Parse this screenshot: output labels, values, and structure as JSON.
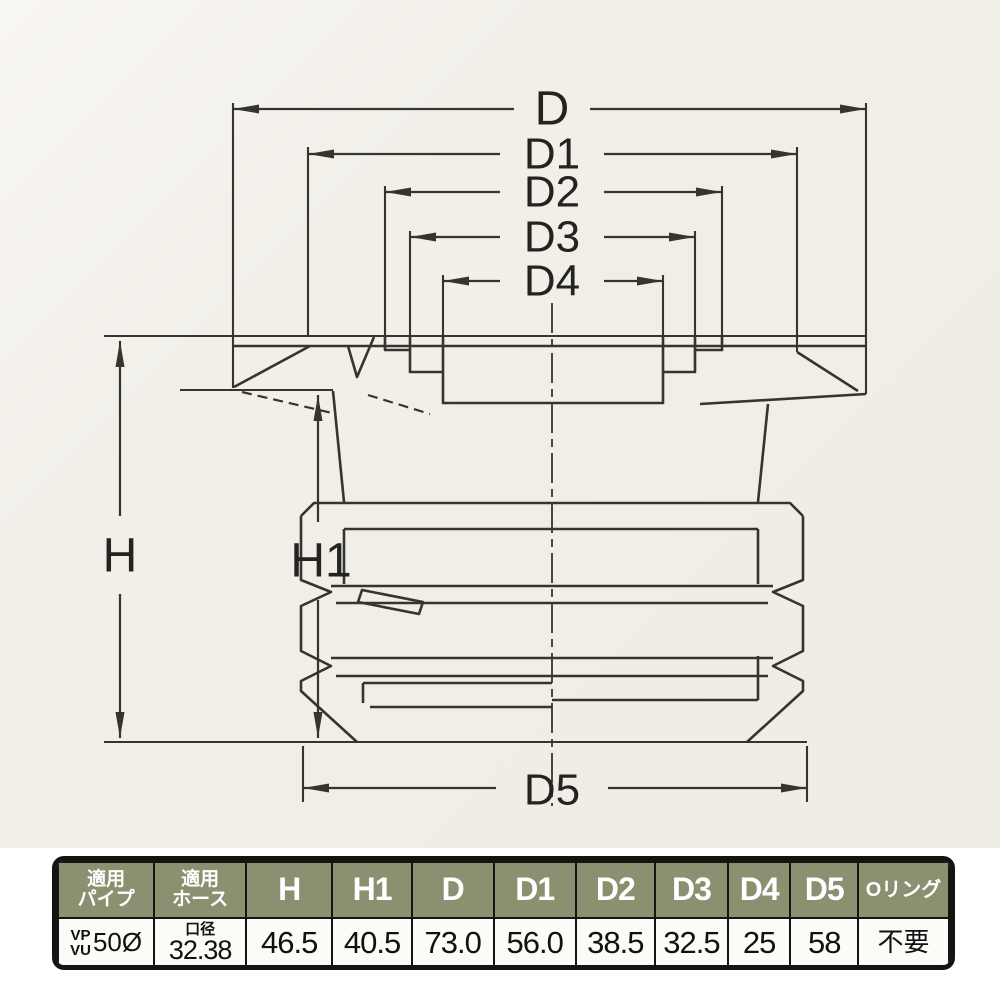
{
  "drawing": {
    "dim_labels": {
      "d": "D",
      "d1": "D1",
      "d2": "D2",
      "d3": "D3",
      "d4": "D4",
      "d5": "D5",
      "h": "H",
      "h1": "H1"
    }
  },
  "table": {
    "headers": {
      "pipe": {
        "line1": "適用",
        "line2": "パイプ"
      },
      "hose": {
        "line1": "適用",
        "line2": "ホース"
      },
      "cols": [
        "H",
        "H1",
        "D",
        "D1",
        "D2",
        "D3",
        "D4",
        "D5"
      ],
      "oring": "Oリング"
    },
    "row": {
      "pipe": {
        "line1": "VP",
        "line2": "VU",
        "size": "50Ø"
      },
      "hose": {
        "line1": "口径",
        "line2": "32.38"
      },
      "values": [
        "46.5",
        "40.5",
        "73.0",
        "56.0",
        "38.5",
        "32.5",
        "25",
        "58"
      ],
      "oring": "不要"
    }
  },
  "colors": {
    "drawing_background": "#f2efe9",
    "line": "#35342f",
    "table_header_bg": "#8a9170",
    "table_border": "#141413",
    "table_body_bg": "#fcfbf8",
    "header_text": "#ffffff"
  }
}
